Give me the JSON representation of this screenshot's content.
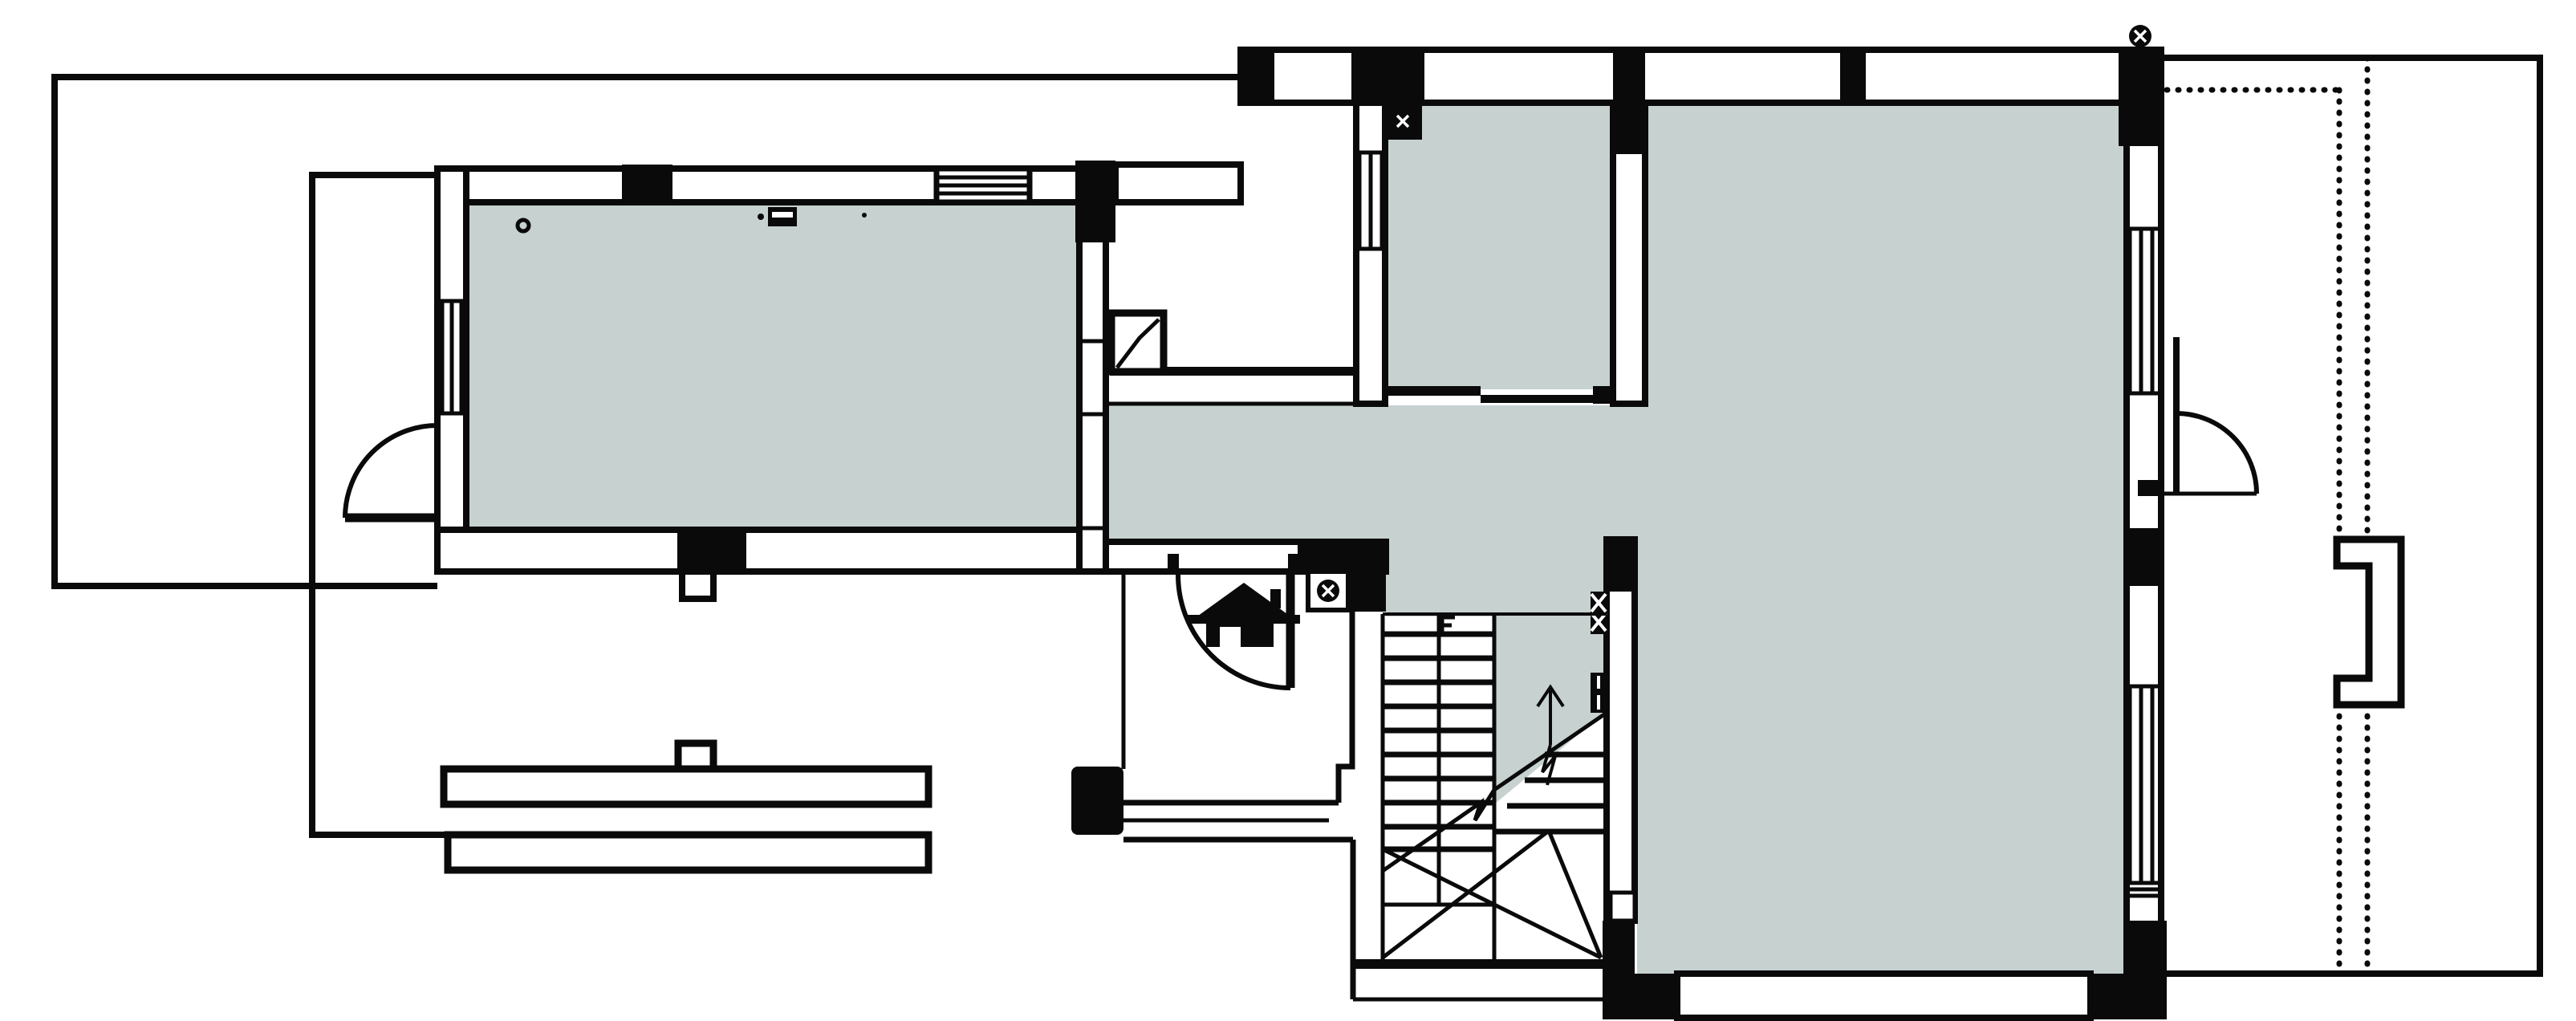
{
  "drawing": {
    "kind": "floor-plan",
    "visible_text": ""
  },
  "colors": {
    "background": "#ffffff",
    "room_fill": "#c6d1d0",
    "line": "#0a0a0a"
  },
  "symbols": {
    "column_marker": "circled-x",
    "stair_direction": "up-arrow-with-break",
    "entrance_marker": "house-icon",
    "window_style": "triple-line",
    "roof_overhang": "dotted-line",
    "section_break": "zigzag-diagonal"
  },
  "rooms": {
    "left_room": "large room left",
    "upper_middle_room": "room top middle",
    "right_room": "large room right",
    "corridor": "hall cross corridor",
    "stair_hall": "staircase hall"
  }
}
